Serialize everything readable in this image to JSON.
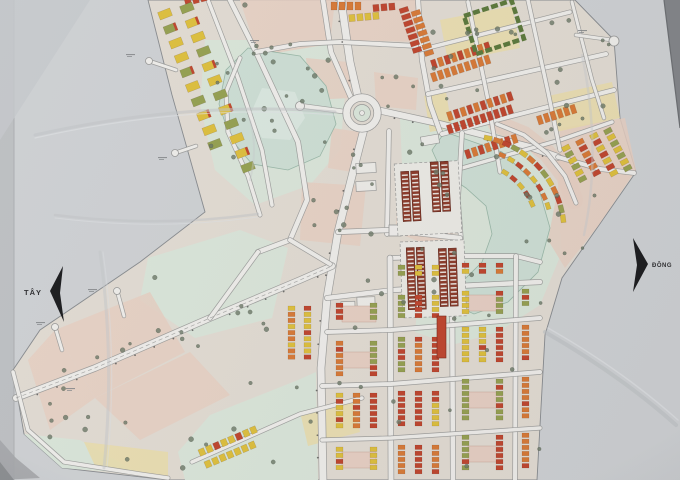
{
  "compass": {
    "west_label": "TÂY",
    "east_label": "ĐÔNG"
  },
  "palette": {
    "paper": "#d3d5d7",
    "paper_edge_dark": "#85878a",
    "map_base": "#e7e0d6",
    "boundary": "#8a8d90",
    "water": "#d2e3d8",
    "water_edge": "#9dbbaa",
    "park": "#dfeadd",
    "parcel_pink": "#ecd3c6",
    "parcel_yellow": "#f0e2ae",
    "road": "#f4f2ee",
    "road_casing": "#9b9b99",
    "house_red": "#c4452c",
    "house_orange": "#dd7b35",
    "house_yellow": "#e3c33c",
    "house_olive": "#98a350",
    "building_green": "#5d7a3a",
    "building_hatched": "#8e3a28",
    "tree": "#6e7a67",
    "arrow": "#1a1a1c",
    "label_text": "#2e2e30"
  }
}
